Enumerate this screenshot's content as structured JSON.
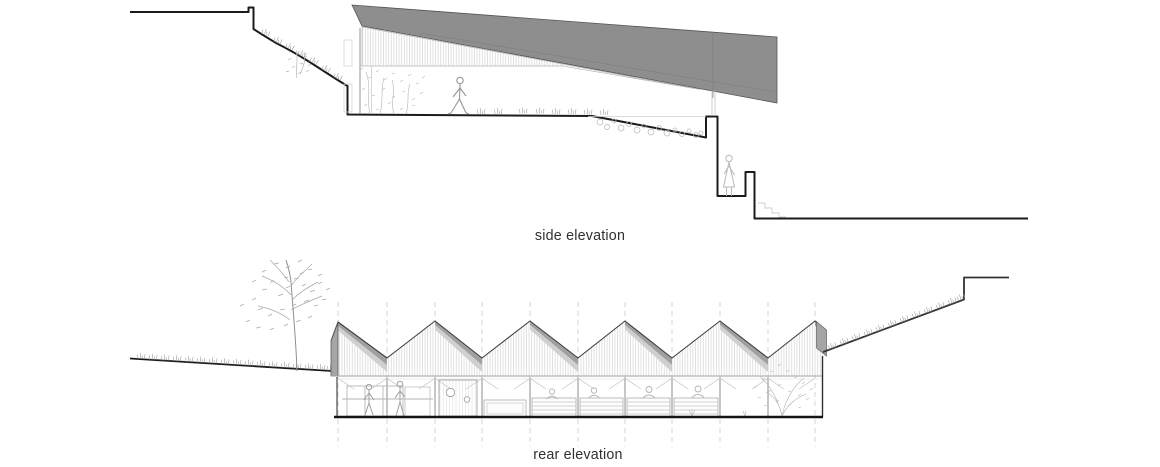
{
  "page": {
    "background": "#ffffff"
  },
  "drawings": [
    {
      "id": "side-elevation",
      "label": "side elevation"
    },
    {
      "id": "rear-elevation",
      "label": "rear elevation"
    }
  ],
  "colors": {
    "ink": "#1b1b1b",
    "roof_gray": "#8e8e8e",
    "end_wall_gray": "#a5a5a5",
    "shadow_dark": "#a0a0a0",
    "shadow_light": "#cfcfcf",
    "light_line": "#b5b5b5",
    "caption_text": "#303030"
  }
}
